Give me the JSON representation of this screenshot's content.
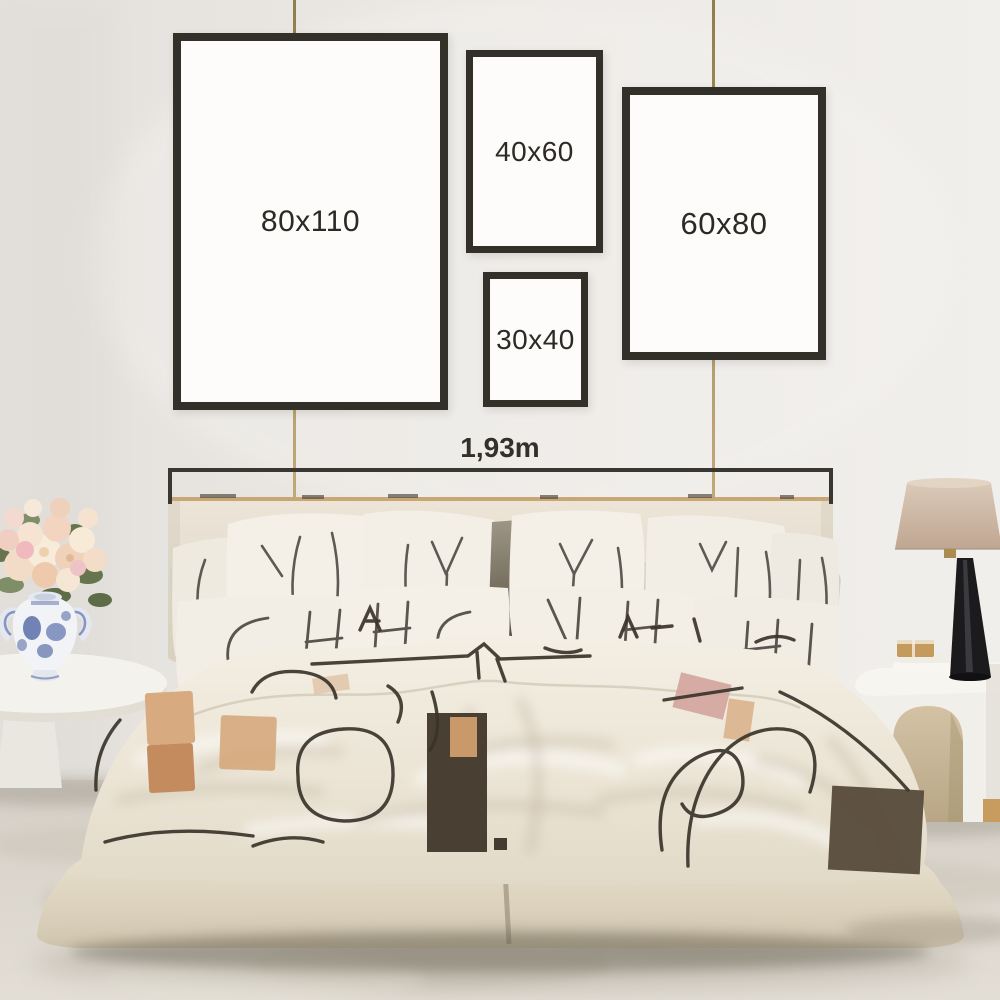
{
  "frames": [
    {
      "id": "80x110",
      "label": "80x110"
    },
    {
      "id": "40x60",
      "label": "40x60"
    },
    {
      "id": "60x80",
      "label": "60x80"
    },
    {
      "id": "30x40",
      "label": "30x40"
    }
  ],
  "measurement": {
    "label": "1,93m"
  },
  "colors": {
    "frame_border": "#33302a",
    "frame_fill": "#fdfcfa",
    "label_text": "#2d2a26",
    "measure_line": "#3a3631",
    "wire_gold": "#a8905c",
    "wall": "#eae7e3",
    "headboard_beige": "#e7dfd2",
    "bedding_cream": "#efe9dd",
    "doodle_charcoal": "#3a342b",
    "accent_tan": "#c48c5e",
    "accent_brown": "#4a3f33",
    "sage_green": "#cfd4c7",
    "vase_blue": "#5b6fa8",
    "lamp_shade": "#cdb8a5",
    "lamp_base": "#1b1b1e",
    "floor_carpet": "#dcd6cd"
  }
}
